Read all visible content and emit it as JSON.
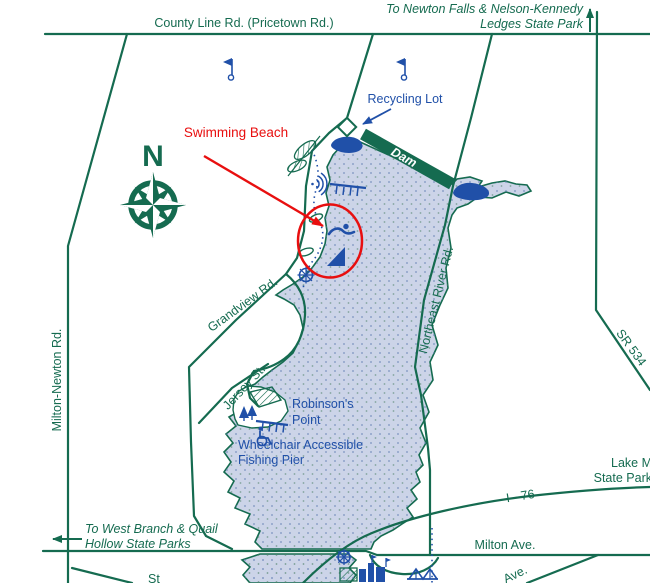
{
  "title": "Lake Milton State Park area map",
  "colors": {
    "road_green": "#156b50",
    "label_blue": "#2050a8",
    "annotation_red": "#e80f0f",
    "lake_fill": "#ccd4e8",
    "lake_stipple": "#6d87b8",
    "dam_fill": "#156b50",
    "background": "#ffffff"
  },
  "labels": {
    "county_line_rd": "County Line Rd. (Pricetown Rd.)",
    "to_newton_line1": "To Newton Falls & Nelson-Kennedy",
    "to_newton_line2": "Ledges State Park",
    "recycling_lot": "Recycling Lot",
    "swimming_beach": "Swimming Beach",
    "dam": "Dam",
    "compass_north": "N",
    "grandview_rd": "Grandview Rd.",
    "jersey_st": "Jersey St.",
    "milton_newton_rd": "Milton-Newton Rd.",
    "northeast_river_rd": "Northeast River Rd.",
    "sr_534": "SR 534",
    "robinsons_point_line1": "Robinson's",
    "robinsons_point_line2": "Point",
    "fishing_pier_line1": "Wheelchair Accessible",
    "fishing_pier_line2": "Fishing Pier",
    "lake_park_line1": "Lake M",
    "lake_park_line2": "State Park",
    "i_76": "I - 76",
    "to_west_branch_line1": "To West Branch & Quail",
    "to_west_branch_line2": "Hollow State Parks",
    "milton_ave": "Milton Ave.",
    "ave_partial": "Ave.",
    "st_partial": "St"
  },
  "icons": {
    "compass_rose": "8-point compass rose",
    "flag": "blue course flag",
    "recycling_lot_marker": "white diamond marker",
    "swimmer": "swimming area symbol",
    "boat_ramp": "boat launch ramp",
    "ships_wheel": "marina ship's wheel",
    "fishing_pier": "pier with dock fingers",
    "amphitheater": "nested arcs symbol",
    "wheelchair": "wheelchair access symbol",
    "trees": "wooded point",
    "marina_buildings": "marina buildings",
    "bridge": "bridge symbol",
    "parking_area": "hatched lot",
    "up_arrow": "continues north arrow",
    "left_arrow": "continues west arrow"
  }
}
